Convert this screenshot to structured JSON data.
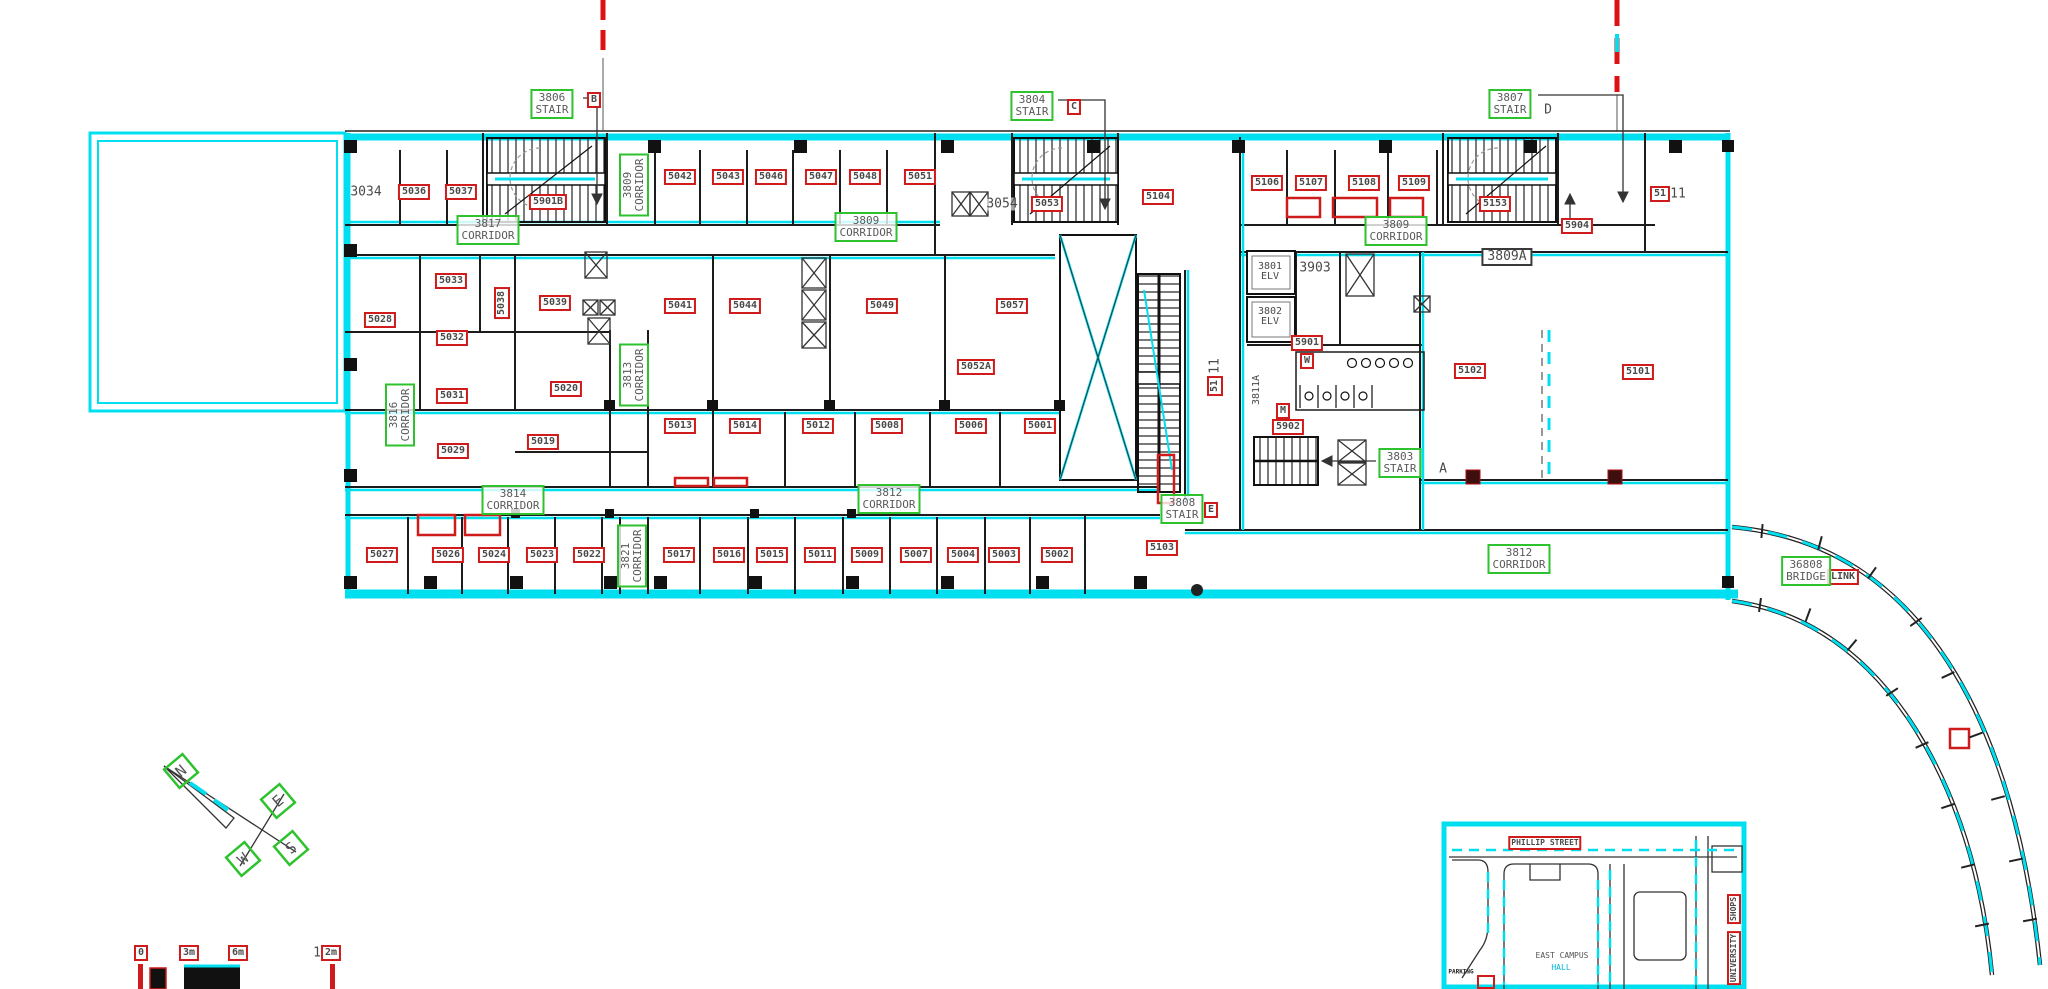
{
  "drawing": {
    "title": "floor-plan-level-38-39",
    "colors": {
      "cyan": "#00dff0",
      "red": "#cf1b1b",
      "green": "#2ec22e",
      "ink": "#1c1c1c"
    },
    "compass": {
      "letters": [
        "N",
        "E",
        "S",
        "W"
      ]
    },
    "labels": {
      "red": [
        {
          "t": "5036",
          "x": 414,
          "y": 192
        },
        {
          "t": "5037",
          "x": 461,
          "y": 192
        },
        {
          "t": "5901B",
          "x": 548,
          "y": 202
        },
        {
          "t": "5042",
          "x": 680,
          "y": 177
        },
        {
          "t": "5043",
          "x": 728,
          "y": 177
        },
        {
          "t": "5046",
          "x": 771,
          "y": 177
        },
        {
          "t": "5047",
          "x": 821,
          "y": 177
        },
        {
          "t": "5048",
          "x": 865,
          "y": 177
        },
        {
          "t": "5051",
          "x": 920,
          "y": 177
        },
        {
          "t": "5053",
          "x": 1047,
          "y": 204
        },
        {
          "t": "5104",
          "x": 1158,
          "y": 197
        },
        {
          "t": "5106",
          "x": 1267,
          "y": 183
        },
        {
          "t": "5107",
          "x": 1311,
          "y": 183
        },
        {
          "t": "5108",
          "x": 1364,
          "y": 183
        },
        {
          "t": "5109",
          "x": 1414,
          "y": 183
        },
        {
          "t": "5153",
          "x": 1495,
          "y": 204
        },
        {
          "t": "5904",
          "x": 1577,
          "y": 226
        },
        {
          "t": "51",
          "x": 1660,
          "y": 194
        },
        {
          "t": "5028",
          "x": 380,
          "y": 320
        },
        {
          "t": "5033",
          "x": 451,
          "y": 281
        },
        {
          "t": "5038",
          "x": 502,
          "y": 303,
          "v": true
        },
        {
          "t": "5039",
          "x": 555,
          "y": 303
        },
        {
          "t": "5032",
          "x": 452,
          "y": 338
        },
        {
          "t": "5031",
          "x": 452,
          "y": 396
        },
        {
          "t": "5029",
          "x": 453,
          "y": 451
        },
        {
          "t": "5041",
          "x": 680,
          "y": 306
        },
        {
          "t": "5044",
          "x": 745,
          "y": 306
        },
        {
          "t": "5049",
          "x": 882,
          "y": 306
        },
        {
          "t": "5057",
          "x": 1012,
          "y": 306
        },
        {
          "t": "5052A",
          "x": 976,
          "y": 367
        },
        {
          "t": "5020",
          "x": 566,
          "y": 389
        },
        {
          "t": "5019",
          "x": 543,
          "y": 442
        },
        {
          "t": "5013",
          "x": 680,
          "y": 426
        },
        {
          "t": "5014",
          "x": 745,
          "y": 426
        },
        {
          "t": "5012",
          "x": 818,
          "y": 426
        },
        {
          "t": "5008",
          "x": 887,
          "y": 426
        },
        {
          "t": "5006",
          "x": 971,
          "y": 426
        },
        {
          "t": "5001",
          "x": 1040,
          "y": 426
        },
        {
          "t": "5901",
          "x": 1307,
          "y": 343
        },
        {
          "t": "W",
          "x": 1307,
          "y": 361
        },
        {
          "t": "M",
          "x": 1283,
          "y": 411
        },
        {
          "t": "5902",
          "x": 1288,
          "y": 427
        },
        {
          "t": "51",
          "x": 1215,
          "y": 386,
          "v": true
        },
        {
          "t": "5102",
          "x": 1470,
          "y": 371
        },
        {
          "t": "5101",
          "x": 1638,
          "y": 372
        },
        {
          "t": "5103",
          "x": 1162,
          "y": 548
        },
        {
          "t": "5027",
          "x": 382,
          "y": 555
        },
        {
          "t": "5026",
          "x": 448,
          "y": 555
        },
        {
          "t": "5024",
          "x": 494,
          "y": 555
        },
        {
          "t": "5023",
          "x": 542,
          "y": 555
        },
        {
          "t": "5022",
          "x": 589,
          "y": 555
        },
        {
          "t": "5017",
          "x": 679,
          "y": 555
        },
        {
          "t": "5016",
          "x": 729,
          "y": 555
        },
        {
          "t": "5015",
          "x": 772,
          "y": 555
        },
        {
          "t": "5011",
          "x": 820,
          "y": 555
        },
        {
          "t": "5009",
          "x": 867,
          "y": 555
        },
        {
          "t": "5007",
          "x": 916,
          "y": 555
        },
        {
          "t": "5004",
          "x": 963,
          "y": 555
        },
        {
          "t": "5003",
          "x": 1004,
          "y": 555
        },
        {
          "t": "5002",
          "x": 1057,
          "y": 555
        },
        {
          "t": "B",
          "x": 594,
          "y": 100
        },
        {
          "t": "C",
          "x": 1074,
          "y": 107
        },
        {
          "t": "E",
          "x": 1211,
          "y": 510
        },
        {
          "t": "LINK",
          "x": 1843,
          "y": 577
        },
        {
          "t": "0",
          "x": 141,
          "y": 953
        },
        {
          "t": "3m",
          "x": 189,
          "y": 953
        },
        {
          "t": "6m",
          "x": 238,
          "y": 953
        },
        {
          "t": "2m",
          "x": 331,
          "y": 953
        },
        {
          "t": "PHILLIP STREET",
          "x": 1545,
          "y": 843,
          "c": "sm"
        },
        {
          "t": "SHOPS",
          "x": 1734,
          "y": 909,
          "v": true,
          "c": "sm"
        },
        {
          "t": "UNIVERSITY",
          "x": 1734,
          "y": 958,
          "v": true,
          "c": "sm"
        }
      ],
      "green": [
        {
          "t": "3806\nSTAIR",
          "x": 552,
          "y": 104
        },
        {
          "t": "3804\nSTAIR",
          "x": 1032,
          "y": 106
        },
        {
          "t": "3807\nSTAIR",
          "x": 1510,
          "y": 104
        },
        {
          "t": "3809\nCORRIDOR",
          "x": 634,
          "y": 185,
          "v": true
        },
        {
          "t": "3817\nCORRIDOR",
          "x": 488,
          "y": 230
        },
        {
          "t": "3809\nCORRIDOR",
          "x": 866,
          "y": 227
        },
        {
          "t": "3809\nCORRIDOR",
          "x": 1396,
          "y": 231
        },
        {
          "t": "3816\nCORRIDOR",
          "x": 400,
          "y": 415,
          "v": true
        },
        {
          "t": "3813\nCORRIDOR",
          "x": 634,
          "y": 375,
          "v": true
        },
        {
          "t": "3814\nCORRIDOR",
          "x": 513,
          "y": 500
        },
        {
          "t": "3812\nCORRIDOR",
          "x": 889,
          "y": 499
        },
        {
          "t": "3821\nCORRIDOR",
          "x": 632,
          "y": 556,
          "v": true
        },
        {
          "t": "3803\nSTAIR",
          "x": 1400,
          "y": 463
        },
        {
          "t": "3808\nSTAIR",
          "x": 1182,
          "y": 509
        },
        {
          "t": "36808\nBRIDGE",
          "x": 1806,
          "y": 571
        },
        {
          "t": "3812\nCORRIDOR",
          "x": 1519,
          "y": 559
        }
      ],
      "plain": [
        {
          "t": "3034",
          "x": 366,
          "y": 192
        },
        {
          "t": "3054",
          "x": 1002,
          "y": 204
        },
        {
          "t": "3903",
          "x": 1315,
          "y": 268
        },
        {
          "t": "3801\nELV",
          "x": 1270,
          "y": 272,
          "c": "sm2"
        },
        {
          "t": "3802\nELV",
          "x": 1270,
          "y": 317,
          "c": "sm2"
        },
        {
          "t": "D",
          "x": 1548,
          "y": 110
        },
        {
          "t": "A",
          "x": 1443,
          "y": 469
        },
        {
          "t": "11",
          "x": 1678,
          "y": 194
        },
        {
          "t": "11",
          "x": 1215,
          "y": 366,
          "v": true
        },
        {
          "t": "3811A",
          "x": 1257,
          "y": 390,
          "v": true,
          "c": "sm2"
        },
        {
          "t": "1",
          "x": 317,
          "y": 953
        },
        {
          "t": "EAST CAMPUS",
          "x": 1562,
          "y": 956,
          "c": "gray-t sm"
        },
        {
          "t": "HALL",
          "x": 1561,
          "y": 968,
          "c": "cyan-t sm"
        },
        {
          "t": "PARKING",
          "x": 1461,
          "y": 972,
          "c": "micro"
        }
      ],
      "boxed": [
        {
          "t": "3809A",
          "x": 1507,
          "y": 257
        }
      ]
    }
  }
}
